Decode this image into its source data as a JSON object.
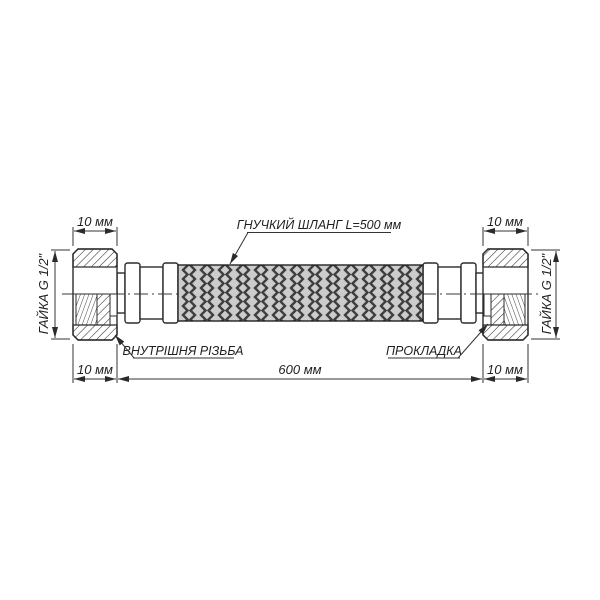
{
  "diagram": {
    "callouts": {
      "hose": "ГНУЧКИЙ ШЛАНГ L=500 мм",
      "internal_thread": "ВНУТРІШНЯ РІЗЬБА",
      "gasket": "ПРОКЛАДКА"
    },
    "dimensions": {
      "nut_width_top_left": "10 мм",
      "nut_width_top_right": "10 мм",
      "nut_width_bottom_left": "10 мм",
      "nut_width_bottom_right": "10 мм",
      "overall_length": "600 мм",
      "nut_thread_left": "ГАЙКА G 1/2\"",
      "nut_thread_right": "ГАЙКА G 1/2\""
    },
    "colors": {
      "line": "#2b2b2b",
      "dim_line": "#333333",
      "braid_background": "#cccccc",
      "braid_strand": "#3f3f3f",
      "page_background": "#ffffff"
    }
  }
}
